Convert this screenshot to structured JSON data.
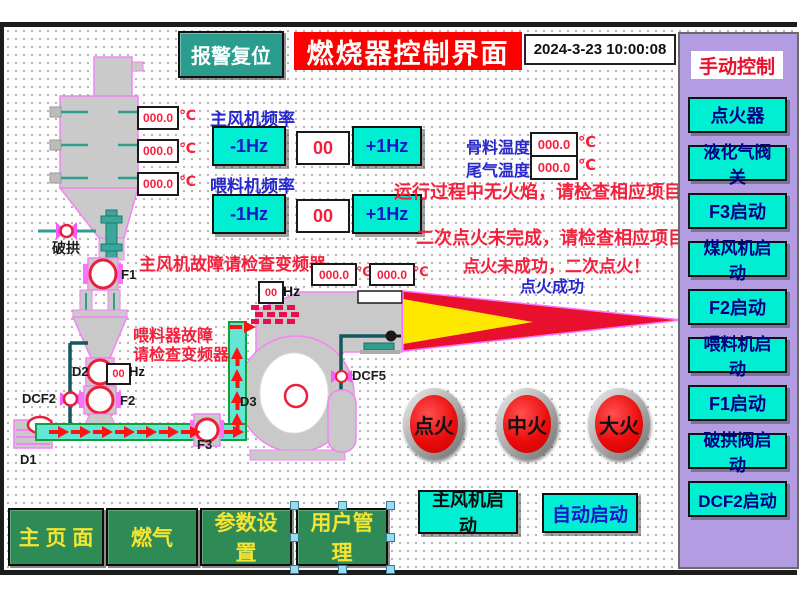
{
  "colors": {
    "accent_cyan": "#00eed2",
    "panel_purple": "#b49ce2",
    "nav_green": "#2e8b55",
    "alarm_red": "#f5203c",
    "label_blue": "#2828cc",
    "title_red": "#ff0000",
    "reset_teal": "#2a9d8f",
    "flame_red": "#e8102c",
    "flame_yellow": "#ffe800"
  },
  "header": {
    "alarm_reset": "报警复位",
    "title": "燃烧器控制界面",
    "datetime": "2024-3-23 10:00:08"
  },
  "sidebar": {
    "title": "手动控制",
    "buttons": [
      "点火器",
      "液化气阀关",
      "F3启动",
      "煤风机启动",
      "F2启动",
      "喂料机启动",
      "F1启动",
      "破拱阀启动",
      "DCF2启动"
    ]
  },
  "frequency": {
    "main_fan_label": "主风机频率",
    "feeder_label": "喂料机频率",
    "dec": "-1Hz",
    "inc": "+1Hz",
    "main_fan_value": "00",
    "feeder_value": "00"
  },
  "hopper_temps": {
    "values": [
      "000.0",
      "000.0",
      "000.0"
    ],
    "unit": "℃"
  },
  "temps": {
    "aggregate_label": "骨料温度",
    "aggregate_value": "000.0",
    "exhaust_label": "尾气温度",
    "exhaust_value": "000.0",
    "burner_values": [
      "000.0",
      "000.0"
    ],
    "unit": "℃"
  },
  "hz": {
    "main_value": "00",
    "feeder_value": "00",
    "unit": "Hz"
  },
  "alarms": {
    "no_flame": "运行过程中无火焰，请检查相应项目！！！",
    "second_ignite": "二次点火未完成，请检查相应项目！！！",
    "ignite_fail": "点火未成功，二次点火！",
    "ignite_ok": "点火成功",
    "main_fan_fault": "主风机故障请检查变频器",
    "feeder_fault_1": "喂料器故障",
    "feeder_fault_2": "请检查变频器"
  },
  "labels": {
    "break_arch": "破拱",
    "f1": "F1",
    "d2": "D2",
    "dcf2": "DCF2",
    "f2": "F2",
    "d1": "D1",
    "f3": "F3",
    "d3": "D3",
    "dcf5": "DCF5"
  },
  "fire_buttons": [
    "点火",
    "中火",
    "大火"
  ],
  "start": {
    "main_fan": "主风机启动",
    "auto": "自动启动"
  },
  "nav": [
    "主 页 面",
    "燃气",
    "参数设置",
    "用户管理"
  ]
}
